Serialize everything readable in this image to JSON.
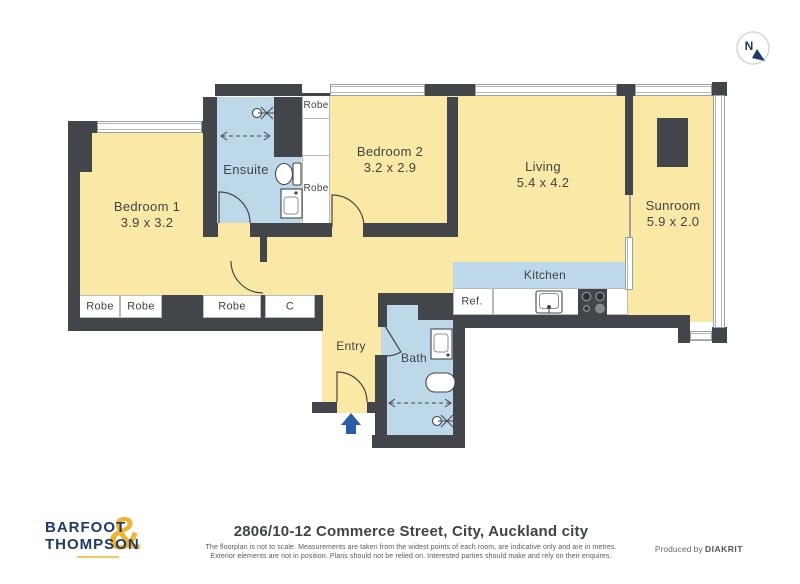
{
  "colors": {
    "wall": "#42464a",
    "room_yellow": "#fae9a4",
    "wet_area_blue": "#bdd8e9",
    "accent_blue": "#2a5caa",
    "logo_navy": "#1e3a6c",
    "logo_gold": "#f2b42d"
  },
  "compass": {
    "label": "N"
  },
  "rooms": {
    "bedroom1": {
      "name": "Bedroom 1",
      "size": "3.9 x 3.2"
    },
    "ensuite": {
      "name": "Ensuite"
    },
    "bedroom2": {
      "name": "Bedroom 2",
      "size": "3.2 x 2.9"
    },
    "living": {
      "name": "Living",
      "size": "5.4 x 4.2"
    },
    "sunroom": {
      "name": "Sunroom",
      "size": "5.9 x 2.0"
    },
    "kitchen": {
      "name": "Kitchen"
    },
    "bath": {
      "name": "Bath"
    },
    "entry": {
      "name": "Entry"
    }
  },
  "fixtures": {
    "fridge": "Ref."
  },
  "closets": {
    "robe": "Robe",
    "cupboard": "C"
  },
  "footer": {
    "address": "2806/10-12 Commerce Street, City, Auckland city",
    "disclaimer_line1": "The floorplan is not to scale. Measurements are taken from the widest points of each room, are indicative only and are in metres.",
    "disclaimer_line2": "Exterior elements are not in position. Plans should not be relied on. Interested parties should make and rely on their enquires.",
    "produced_by": "Produced by",
    "producer": "DIAKRIT"
  },
  "logo": {
    "word1": "BARFOOT",
    "word2": "THOMPSON",
    "ampersand": "&"
  }
}
